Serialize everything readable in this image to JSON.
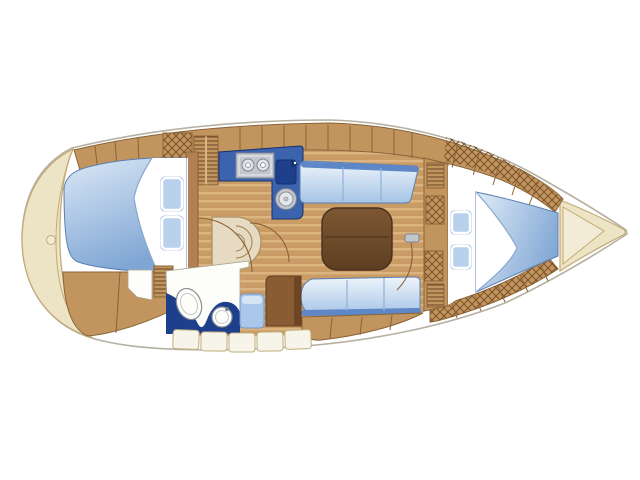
{
  "diagram": {
    "kind": "sailboat-interior-floor-plan",
    "canvas": {
      "width": 640,
      "height": 480
    }
  },
  "colors": {
    "pageBg": "#ffffff",
    "white": "#ffffff",
    "hullLine": "#b6b0a0",
    "deckCream": "#ede4c5",
    "deckCreamEdge": "#c3aa76",
    "deckCreamInner": "#f2ecd6",
    "wood": "#c2955f",
    "woodEdge": "#8a6337",
    "wallWood": "#b28052",
    "plankBase": "#ca9c65",
    "plankStripe": "#dcb47f",
    "hatchLine": "#6f4e2a",
    "crossLine": "#7a5228",
    "berthLight": "#dbe8f6",
    "berthDeep": "#7fa6d4",
    "berthEdge": "#5b7fb4",
    "sheetFold": "#8aa8cc",
    "pillowFill": "#b9d1ec",
    "pillowEdge": "#8fb0d4",
    "cushionLight": "#eff5fb",
    "cushionDeep": "#a5c4e6",
    "cushionEdge": "#5b7fb4",
    "cushionDivider": "#8fb2d9",
    "backrestBlue": "#5d87c6",
    "galleyBlue": "#3c64ae",
    "galleyNavy": "#1e3f8c",
    "navyDark": "#16306e",
    "counterNavy": "#1e3f8c",
    "steelLight": "#e2e5e9",
    "steelMid": "#c3c7cd",
    "steelDark": "#7d838d",
    "tableWood": "#7d5733",
    "tableWoodDark": "#5e3e22",
    "tableEdge": "#46301a",
    "seatBeige": "#e6dac2",
    "seatBeigeEdge": "#a8905f",
    "roomWhite": "#fdfdfa",
    "roomEdge": "#a9a292",
    "fixtureEdge": "#8a9098",
    "showerSeat": "#a9c8ea",
    "showerSeatEdge": "#7396c4",
    "showerSeatTop": "#d5e4f4",
    "cabinetBrown": "#8a5c33",
    "cabinetBrownDark": "#6e4525",
    "cabinetBrownEdge": "#5f3d1e",
    "benchTile": "#f7f4e9",
    "benchTileEdge": "#bfae7e",
    "doorArc": "#8a6038"
  }
}
